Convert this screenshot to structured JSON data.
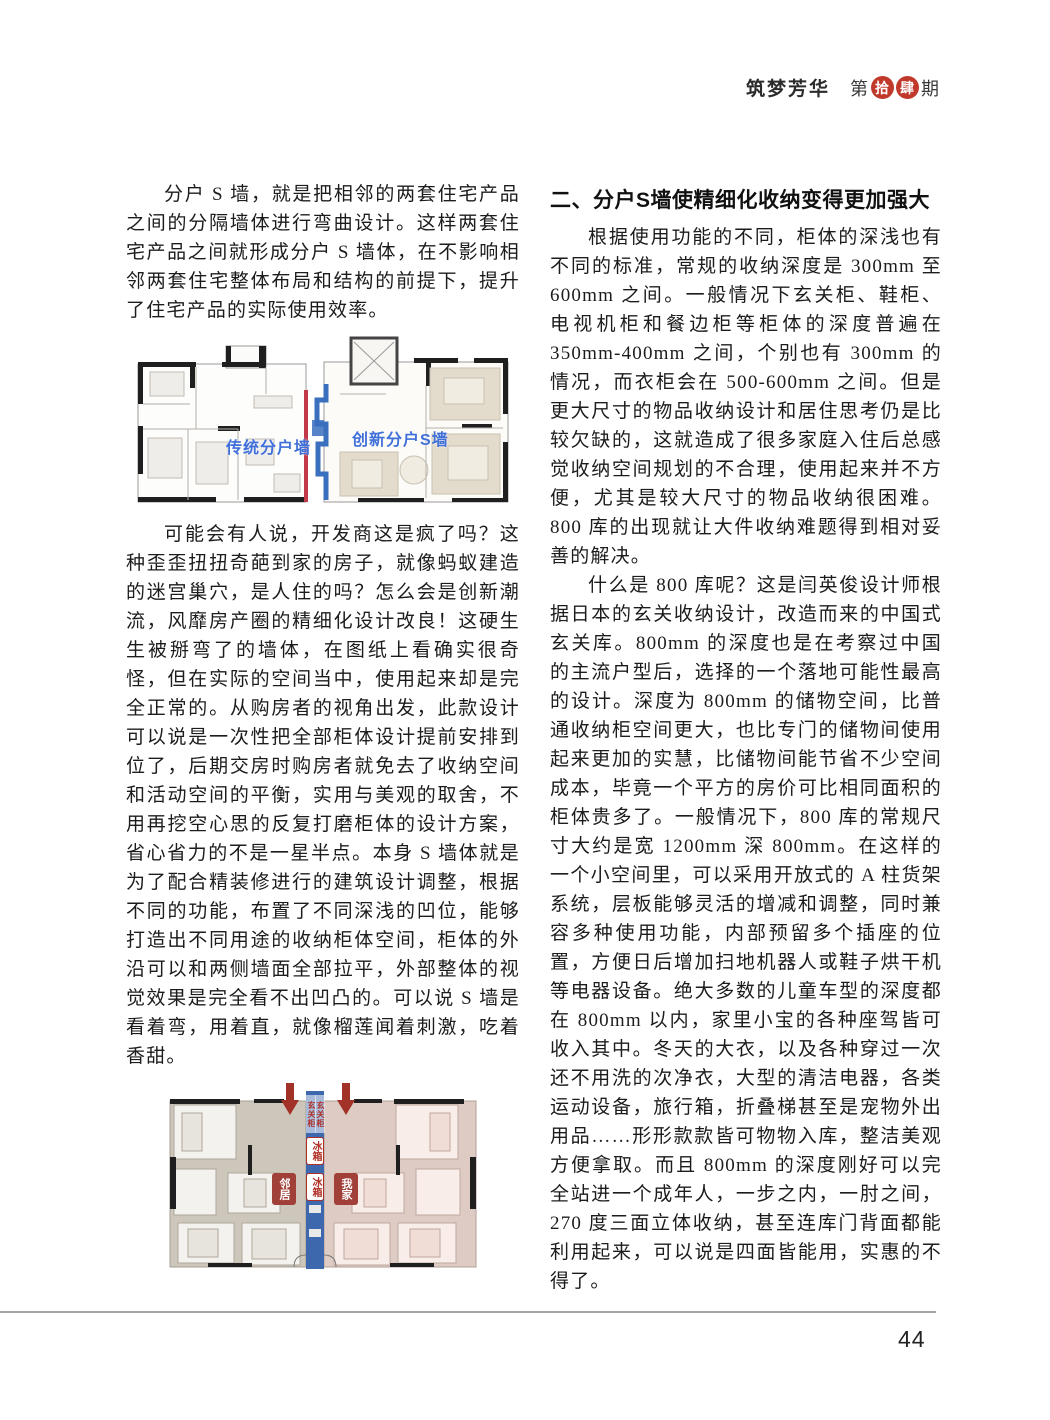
{
  "header": {
    "magazine_title": "筑梦芳华",
    "issue_prefix": "第",
    "issue_seal_1": "拾",
    "issue_seal_2": "肆",
    "issue_suffix": "期"
  },
  "left_column": {
    "para1": "分户 S 墙，就是把相邻的两套住宅产品之间的分隔墙体进行弯曲设计。这样两套住宅产品之间就形成分户 S 墙体，在不影响相邻两套住宅整体布局和结构的前提下，提升了住宅产品的实际使用效率。",
    "figure1": {
      "left_plan_label": "传统分户墙",
      "right_plan_label": "创新分户S墙"
    },
    "para2": "可能会有人说，开发商这是疯了吗？这种歪歪扭扭奇葩到家的房子，就像蚂蚁建造的迷宫巢穴，是人住的吗？怎么会是创新潮流，风靡房产圈的精细化设计改良！这硬生生被掰弯了的墙体，在图纸上看确实很奇怪，但在实际的空间当中，使用起来却是完全正常的。从购房者的视角出发，此款设计可以说是一次性把全部柜体设计提前安排到位了，后期交房时购房者就免去了收纳空间和活动空间的平衡，实用与美观的取舍，不用再挖空心思的反复打磨柜体的设计方案，省心省力的不是一星半点。本身 S 墙体就是为了配合精装修进行的建筑设计调整，根据不同的功能，布置了不同深浅的凹位，能够打造出不同用途的收纳柜体空间，柜体的外沿可以和两侧墙面全部拉平，外部整体的视觉效果是完全看不出凹凸的。可以说 S 墙是看着弯，用着直，就像榴莲闻着刺激，吃着香甜。",
    "figure2": {
      "cabinet_label_left": "玄关柜",
      "cabinet_label_right": "玄关柜",
      "fridge_label_1": "冰箱",
      "fridge_label_2": "冰箱",
      "neighbor_badge": "邻居",
      "my_home_badge": "我家"
    }
  },
  "right_column": {
    "heading": "二、分户S墙使精细化收纳变得更加强大",
    "para1": "根据使用功能的不同，柜体的深浅也有不同的标准，常规的收纳深度是 300mm 至 600mm 之间。一般情况下玄关柜、鞋柜、电视机柜和餐边柜等柜体的深度普遍在 350mm-400mm 之间，个别也有 300mm 的情况，而衣柜会在 500-600mm 之间。但是更大尺寸的物品收纳设计和居住思考仍是比较欠缺的，这就造成了很多家庭入住后总感觉收纳空间规划的不合理，使用起来并不方便，尤其是较大尺寸的物品收纳很困难。800 库的出现就让大件收纳难题得到相对妥善的解决。",
    "para2": "什么是 800 库呢？这是闫英俊设计师根据日本的玄关收纳设计，改造而来的中国式玄关库。800mm 的深度也是在考察过中国的主流户型后，选择的一个落地可能性最高的设计。深度为 800mm 的储物空间，比普通收纳柜空间更大，也比专门的储物间使用起来更加的实慧，比储物间能节省不少空间成本，毕竟一个平方的房价可比相同面积的柜体贵多了。一般情况下，800 库的常规尺寸大约是宽 1200mm 深 800mm。在这样的一个小空间里，可以采用开放式的 A 柱货架系统，层板能够灵活的增减和调整，同时兼容多种使用功能，内部预留多个插座的位置，方便日后增加扫地机器人或鞋子烘干机等电器设备。绝大多数的儿童车型的深度都在 800mm 以内，家里小宝的各种座驾皆可收入其中。冬天的大衣，以及各种穿过一次还不用洗的次净衣，大型的清洁电器，各类运动设备，旅行箱，折叠梯甚至是宠物外出用品……形形款款皆可物物入库，整洁美观方便拿取。而且 800mm 的深度刚好可以完全站进一个成年人，一步之内，一肘之间，270 度三面立体收纳，甚至连库门背面都能利用起来，可以说是四面皆能用，实惠的不得了。"
  },
  "footer": {
    "page_number": "44"
  },
  "colors": {
    "seal_red": "#c0392b",
    "plan_label_blue": "#3f6fd8",
    "traditional_wall_red": "#c23a4a",
    "s_wall_blue": "#3a6fbe",
    "badge_dark_red": "#a04038",
    "arrow_red": "#a23227"
  }
}
